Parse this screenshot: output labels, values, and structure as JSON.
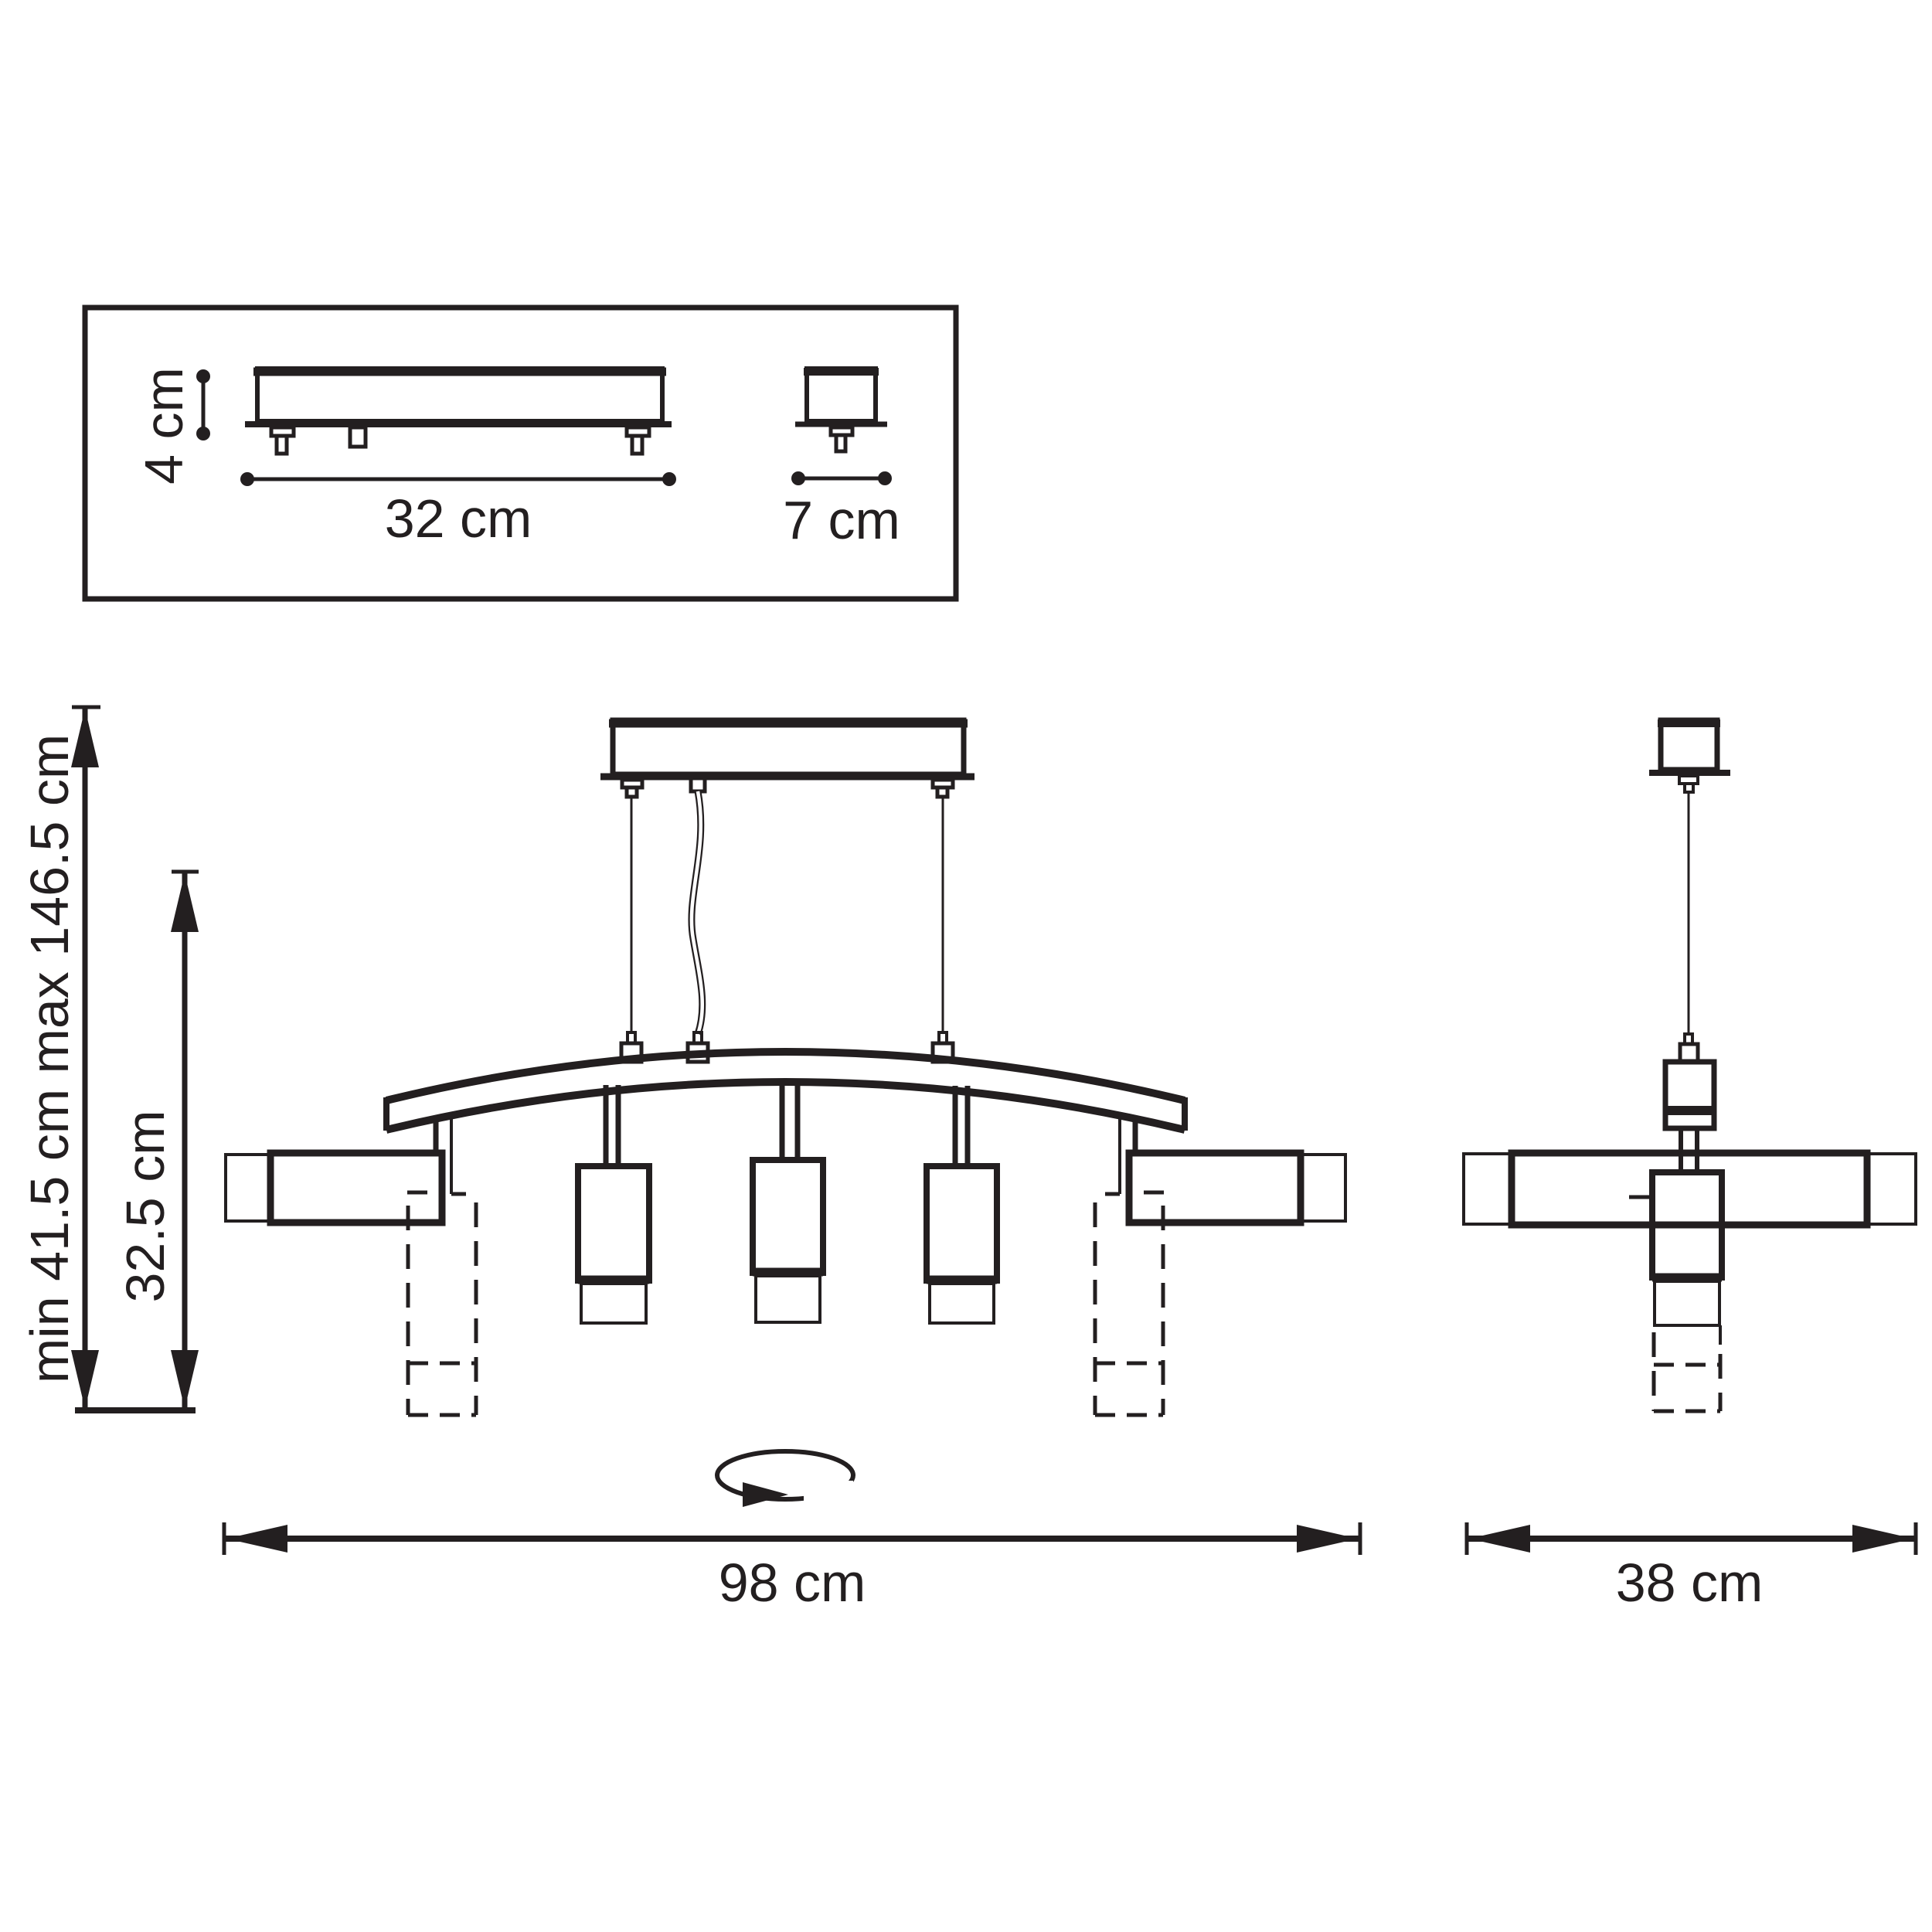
{
  "drawing": {
    "type": "technical-dimension-drawing",
    "subject": "linear pendant chandelier with five cylindrical shades",
    "colors": {
      "line": "#231f20",
      "background": "#ffffff"
    }
  },
  "inset": {
    "height_label": "4 cm",
    "length_label": "32 cm",
    "width_label": "7 cm"
  },
  "front_view": {
    "suspension_label": "min 41.5 cm max 146.5 cm",
    "drop_label": "32.5 cm",
    "width_label": "98 cm"
  },
  "side_view": {
    "width_label": "38 cm"
  }
}
